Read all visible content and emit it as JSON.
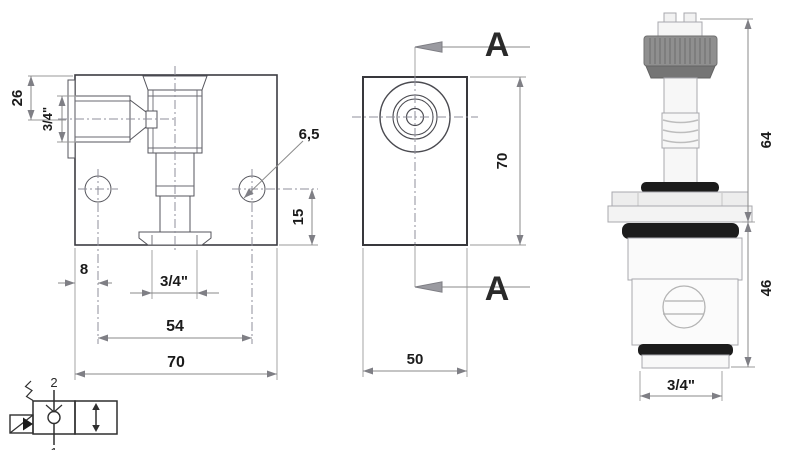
{
  "front_view": {
    "dim_depth_top": "26",
    "side_port": "3/4\"",
    "hole_diameter": "6,5",
    "dim_hole_to_bottom": "15",
    "dim_edge_to_hole": "8",
    "bottom_port": "3/4\"",
    "dim_hole_spacing": "54",
    "dim_width": "70"
  },
  "side_view": {
    "section_top": "A",
    "section_bottom": "A",
    "dim_height": "70",
    "dim_depth": "50"
  },
  "cartridge": {
    "dim_upper_length": "64",
    "dim_cartridge_length": "46",
    "thread_size": "3/4\""
  },
  "symbol": {
    "port_top": "2",
    "port_bottom": "1"
  },
  "colors": {
    "object_line": "#3c3c42",
    "dimension_line": "#8a8a8a",
    "hatch": "#a6a6b0",
    "text": "#1b1b1b",
    "knurl_gray": "#8f8f8f",
    "knurl_dark": "#757575",
    "oring_black": "#1c1c1c",
    "body_white": "#f9f9f9"
  }
}
